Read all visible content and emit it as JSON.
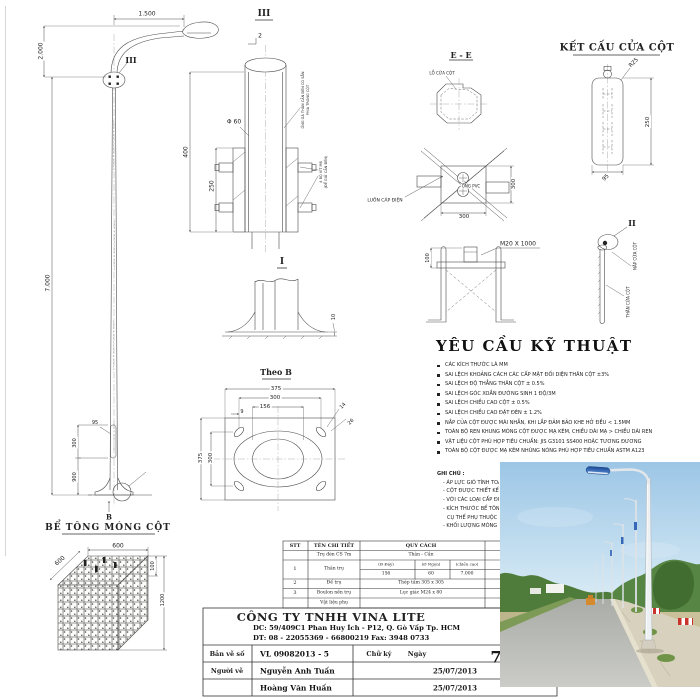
{
  "pole": {
    "arm_len": "1.500",
    "arm_h": "2.000",
    "height": "7.000",
    "ref3": "III",
    "d95": "95",
    "d300": "300",
    "d900": "900",
    "refB": "B",
    "found_title": "BỂ TÔNG MÓNG CỘT"
  },
  "cube": {
    "top": "600",
    "side": "600",
    "d100": "100",
    "d1200": "1200"
  },
  "d3": {
    "t": "III",
    "r2": "2",
    "d60": "Φ 60",
    "d400": "400",
    "d250": "250",
    "n1a": "ỐNG GÁ THÂN CẦN ĐÈN CÓ SẴN",
    "n1b": "PHÍA TRONG CỘT",
    "n2a": "4 BỘ VÍT M8",
    "n2b": "(ĐỂ GIỮ CẦN ĐÈN)"
  },
  "d1": {
    "t": "I",
    "d10": "10"
  },
  "theob": {
    "t": "Theo B",
    "d375": "375",
    "d300": "300",
    "d156": "156",
    "d9": "9",
    "d14": "14",
    "d26": "26",
    "v375": "375",
    "v300": "300"
  },
  "ee": {
    "t": "E - E",
    "core": "LỖ CỬA CỘT"
  },
  "aplan": {
    "cable": "LUỒN CÁP ĐIỆN",
    "pvc": "ỐNG PVC",
    "d300v": "300",
    "d300h": "300"
  },
  "acage": {
    "bolt": "M20 X 1000",
    "d100": "100"
  },
  "door": {
    "t": "KẾT CẤU CỬA CỘT",
    "r25": "R25",
    "d250": "250",
    "d95": "95"
  },
  "d2": {
    "t": "II",
    "cap": "NẮP CỬA CỘT",
    "body": "THÂN CỬA CỘT"
  },
  "reqs": {
    "title": "YÊU CẦU KỸ THUẬT",
    "items": [
      "CÁC KÍCH THƯỚC LÀ MM",
      "SAI LỆCH KHOẢNG CÁCH CÁC CẤP MẶT ĐỐI DIỆN THÂN CỘT  ±3%",
      "SAI LỆCH ĐỘ THẲNG THÂN CỘT  ± 0.5%",
      "SAI LỆCH GÓC XOẮN ĐƯỜNG SINH  1 ĐỘ/3M",
      "SAI LỆCH CHIỀU CAO CỘT  ± 0.5%",
      "SAI LỆCH CHIỀU CAO ĐẶT ĐÈN  ± 1.2%",
      "NẮP CỦA CỘT ĐƯỢC MÀI NHẴN, KHI LẮP ĐẢM BẢO KHE HỞ ĐỀU < 1.5MM",
      "TOÀN BỘ REN KHUNG MÓNG CỘT ĐƯỢC MẠ KẼM, CHIỀU DÀI MẠ > CHIỀU DÀI REN",
      "VẬT LIỆU CỘT PHÙ HỢP TIÊU CHUẨN: JIS G3101 SS400 HOẶC TƯƠNG ĐƯƠNG",
      "TOÀN BỘ CỘT ĐƯỢC MẠ KẼM NHÚNG NÓNG PHÙ HỢP TIÊU CHUẨN ASTM A123"
    ]
  },
  "notes": {
    "title": "GHI CHÚ :",
    "lines": [
      "- ÁP LỰC GIÓ TÍNH TOÁN",
      "- CỘT ĐƯỢC THIẾT KẾ VỚI",
      "- VỚI CÁC LOẠI CẤP ĐIỆN",
      "- KÍCH THƯỚC BỂ TÔNG MÓNG",
      "CỤ THỂ PHỤ THUỘC VÀO NỀN",
      "- KHỐI LƯỢNG MÓNG CỘT"
    ]
  },
  "table": {
    "h_stt": "STT",
    "h_ten": "TÊN CHI TIẾT",
    "h_quy": "QUY CÁCH",
    "p_name": "Trụ đèn CS 7m",
    "p_spec": "Thân - Cần",
    "r1_stt": "1",
    "r1_name": "Thân trụ",
    "r1_c1": "(Ø Đáy)",
    "r1_c2": "(Ø Ngọn)",
    "r1_c3": "(chiều cao)",
    "r1_v1": "156",
    "r1_v2": "60",
    "r1_v3": "7.000",
    "r2_stt": "2",
    "r2_name": "Đế trụ",
    "r2_spec": "Thép tấm 305 x 305",
    "r3_stt": "3",
    "r3_name": "Boulon nền trụ",
    "r3_spec": "Lục giác M24 x 80",
    "r4_name": "Vật liệu phụ"
  },
  "tb": {
    "company": "CÔNG TY TNHH VINA LITE",
    "addr": "DC: 59/409C1 Phan Huy Ích - P12, Q. Gò Vấp Tp. HCM",
    "tel": "DT: 08 - 22055369 - 66800219   Fax: 3948 0733",
    "l1": "Bản vẽ số",
    "no": "VL 09082013 - 5",
    "sig": "Chữ ký",
    "date": "Ngày",
    "l2": "Người vẽ",
    "n1": "Nguyễn Anh Tuấn",
    "d1": "25/07/2013",
    "n2": "Hoàng Văn Huấn",
    "d2": "25/07/2013",
    "page": "7"
  },
  "colors": {
    "sky_top": "#9cc6e6",
    "sky_bottom": "#dcedf6",
    "lamp_dark": "#1b4b96",
    "lamp_light": "#5d8fd6",
    "tree_green": "#568544",
    "barrier_red": "#c8332b",
    "road_gray": "#aaaca8"
  }
}
